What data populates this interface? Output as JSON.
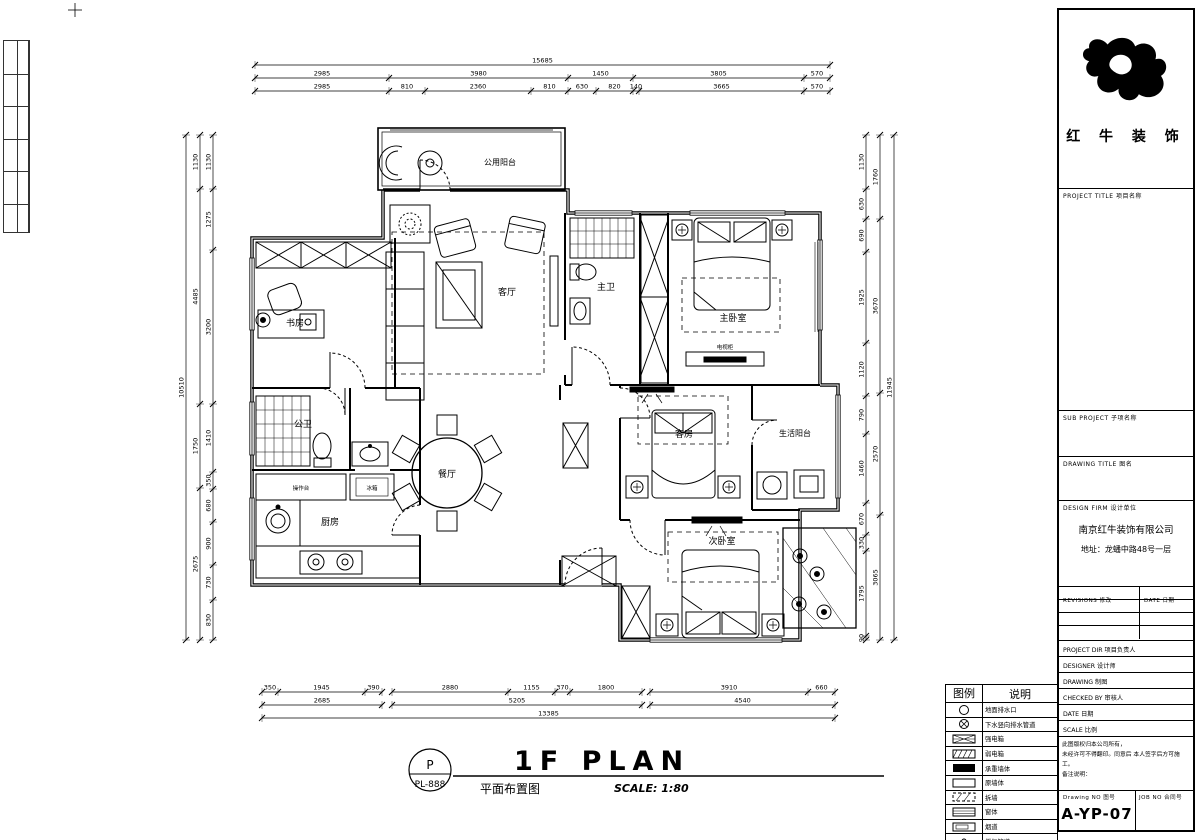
{
  "title_block": {
    "company_name": "红 牛 装 饰",
    "project_title": "PROJECT TITLE  项目名称",
    "sub_project": "SUB PROJECT  子项名称",
    "drawing_title": "DRAWING TITLE  图名",
    "design_firm": "DESIGN FIRM  设计单位",
    "company_full": "南京红牛装饰有限公司",
    "company_address": "地址：龙蟠中路48号一层",
    "revisions": "REVISIONS  修改",
    "revisions_date": "DATE  日期",
    "field_rows": [
      "PROJECT DIR   项目负责人",
      "DESIGNER      设计师",
      "DRAWING       制图",
      "CHECKED BY    审核人",
      "DATE          日期",
      "SCALE         比例"
    ],
    "note_line1": "此图版权归本公司所有，",
    "note_line2": "未经许可不得翻印。同意后 本人签字后方可施工。",
    "note_line3": "备注说明：",
    "drawing_no_label": "Drawing NO  图号",
    "drawing_no": "A-YP-07",
    "job_no_label": "JOB NO  合同号"
  },
  "legend": {
    "header_icon": "图例",
    "header_desc": "说明",
    "items": [
      {
        "icon": "drain-circle",
        "label": "地面排水口"
      },
      {
        "icon": "circle-cross",
        "label": "下水竖向排水管道"
      },
      {
        "icon": "box-crosshatch",
        "label": "强电箱"
      },
      {
        "icon": "box-hatch",
        "label": "弱电箱"
      },
      {
        "icon": "box-solid",
        "label": "承重墙体"
      },
      {
        "icon": "box-empty",
        "label": "原墙体"
      },
      {
        "icon": "box-dash-hatch",
        "label": "拆墙"
      },
      {
        "icon": "box-lines",
        "label": "窗体"
      },
      {
        "icon": "box-duct",
        "label": "烟道"
      },
      {
        "icon": "dot",
        "label": "燃气管道"
      }
    ]
  },
  "plan": {
    "rooms": {
      "public_balcony": "公用阳台",
      "living": "客厅",
      "study": "书房",
      "master_bath": "主卫",
      "master_bedroom": "主卧室",
      "bath": "公卫",
      "kitchen": "厨房",
      "dining": "餐厅",
      "guest_room": "客房",
      "service_balcony": "生活阳台",
      "second_bedroom": "次卧室"
    },
    "furniture": {
      "counter": "操作台",
      "fridge": "冰箱",
      "tv_cabinet": "电视柜"
    }
  },
  "dims": {
    "top": {
      "overall": "15685",
      "row1": [
        "2985",
        "3980",
        "1450",
        "3805",
        "570"
      ],
      "row2": [
        "2985",
        "810",
        "2360",
        "810",
        "630",
        "820",
        "140",
        "3665",
        "570"
      ]
    },
    "bottom": {
      "row1": [
        "350",
        "1945",
        "390",
        "2880",
        "1155",
        "370",
        "1800",
        "3910",
        "660"
      ],
      "row2": [
        "2685",
        "5205",
        "4540"
      ],
      "overall": "13385"
    },
    "left": {
      "overall": "10510",
      "outer": [
        "1130",
        "4485",
        "1750",
        "2675"
      ],
      "inner": [
        "1130",
        "1275",
        "3200",
        "1410",
        "350",
        "680",
        "900",
        "730",
        "830"
      ]
    },
    "right": {
      "overall": "11945",
      "mid": [
        "1760",
        "3670",
        "2570",
        "3065"
      ],
      "inner": [
        "1130",
        "630",
        "690",
        "1925",
        "1120",
        "790",
        "1460",
        "670",
        "330",
        "1795",
        "90"
      ]
    }
  },
  "footer": {
    "ref_top": "P",
    "ref_no": "PL-888",
    "title_en": "1F PLAN",
    "title_cn": "平面布置图",
    "scale": "SCALE: 1:80"
  }
}
